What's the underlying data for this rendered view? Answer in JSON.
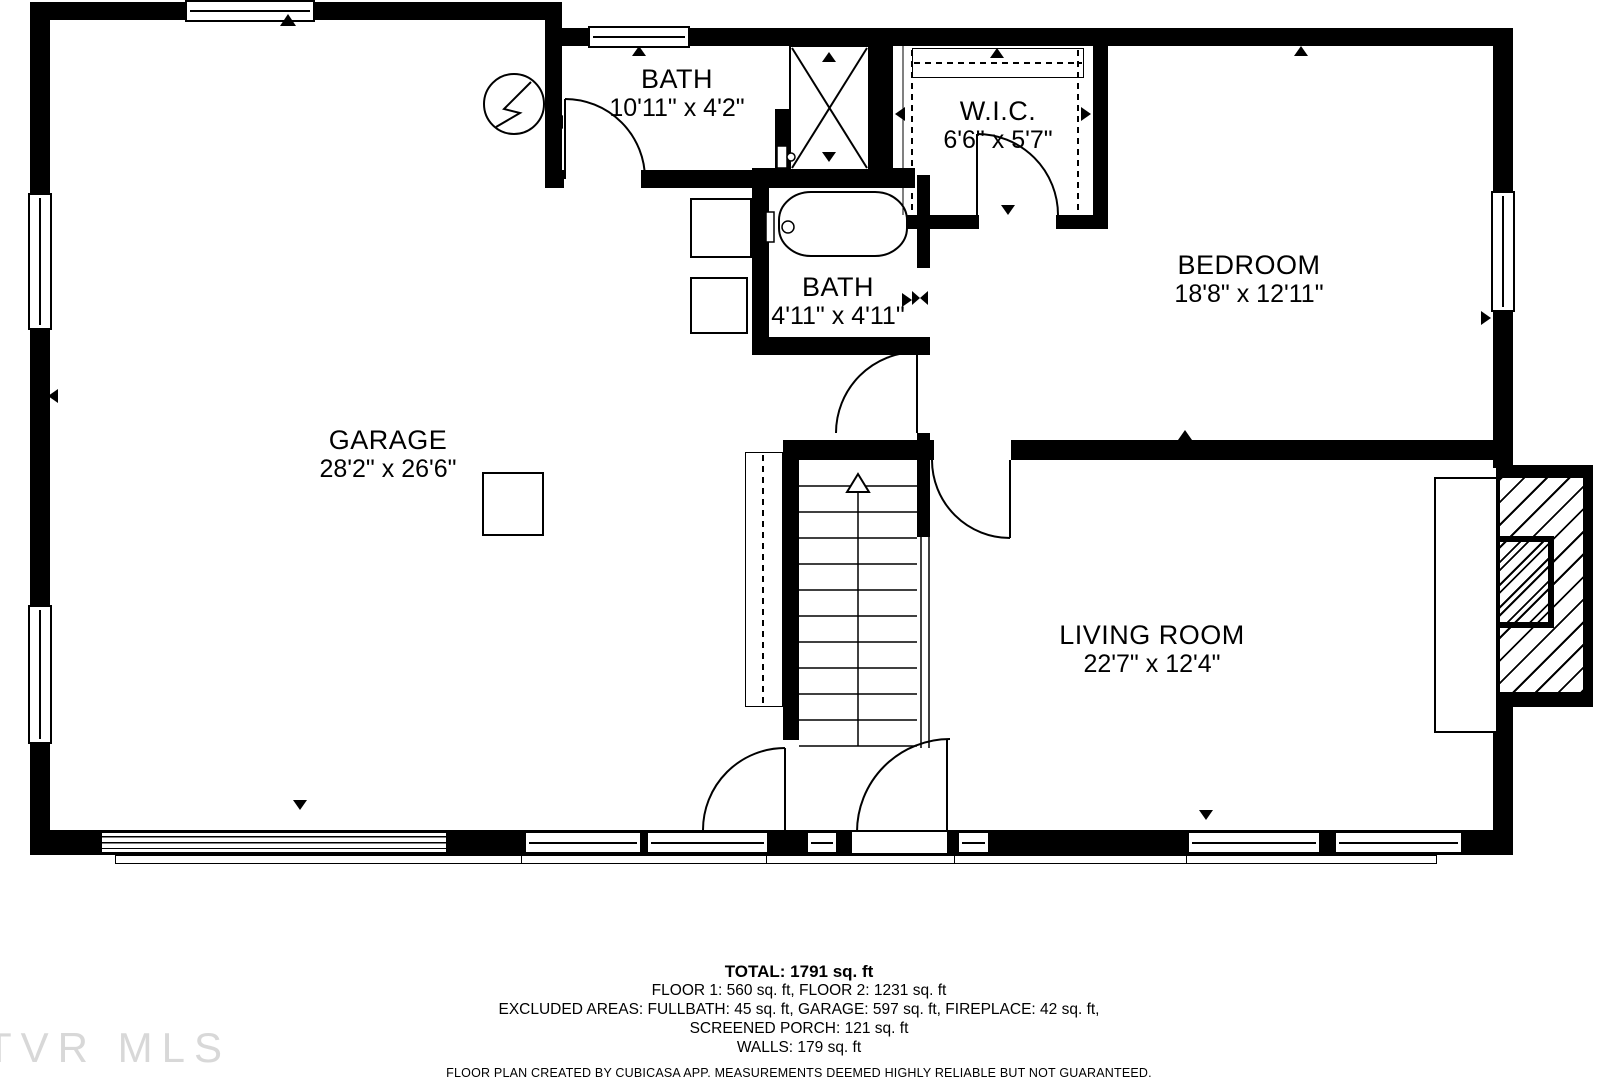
{
  "watermark": "TVR MLS",
  "rooms": [
    {
      "id": "bath-upper",
      "name": "BATH",
      "dims": "10'11\" x 4'2\""
    },
    {
      "id": "wic",
      "name": "W.I.C.",
      "dims": "6'6\" x 5'7\""
    },
    {
      "id": "bedroom",
      "name": "BEDROOM",
      "dims": "18'8\" x 12'11\""
    },
    {
      "id": "bath-lower",
      "name": "BATH",
      "dims": "4'11\" x 4'11\""
    },
    {
      "id": "garage",
      "name": "GARAGE",
      "dims": "28'2\" x 26'6\""
    },
    {
      "id": "living-room",
      "name": "LIVING ROOM",
      "dims": "22'7\" x 12'4\""
    }
  ],
  "summary": {
    "total": "TOTAL: 1791 sq. ft",
    "floors": "FLOOR 1: 560 sq. ft, FLOOR 2: 1231 sq. ft",
    "excluded1": "EXCLUDED AREAS: FULLBATH: 45 sq. ft, GARAGE: 597 sq. ft, FIREPLACE: 42 sq. ft,",
    "excluded2": "SCREENED PORCH: 121 sq. ft",
    "walls": "WALLS: 179 sq. ft"
  },
  "disclaimer": "FLOOR PLAN CREATED BY CUBICASA APP. MEASUREMENTS DEEMED HIGHLY RELIABLE BUT NOT GUARANTEED.",
  "icons": {
    "electrical-panel-icon": "circle with lightning bolt",
    "stairs-direction-icon": "up arrow",
    "opening-marker-icon": "filled triangle",
    "shower-icon": "rectangle with X"
  }
}
